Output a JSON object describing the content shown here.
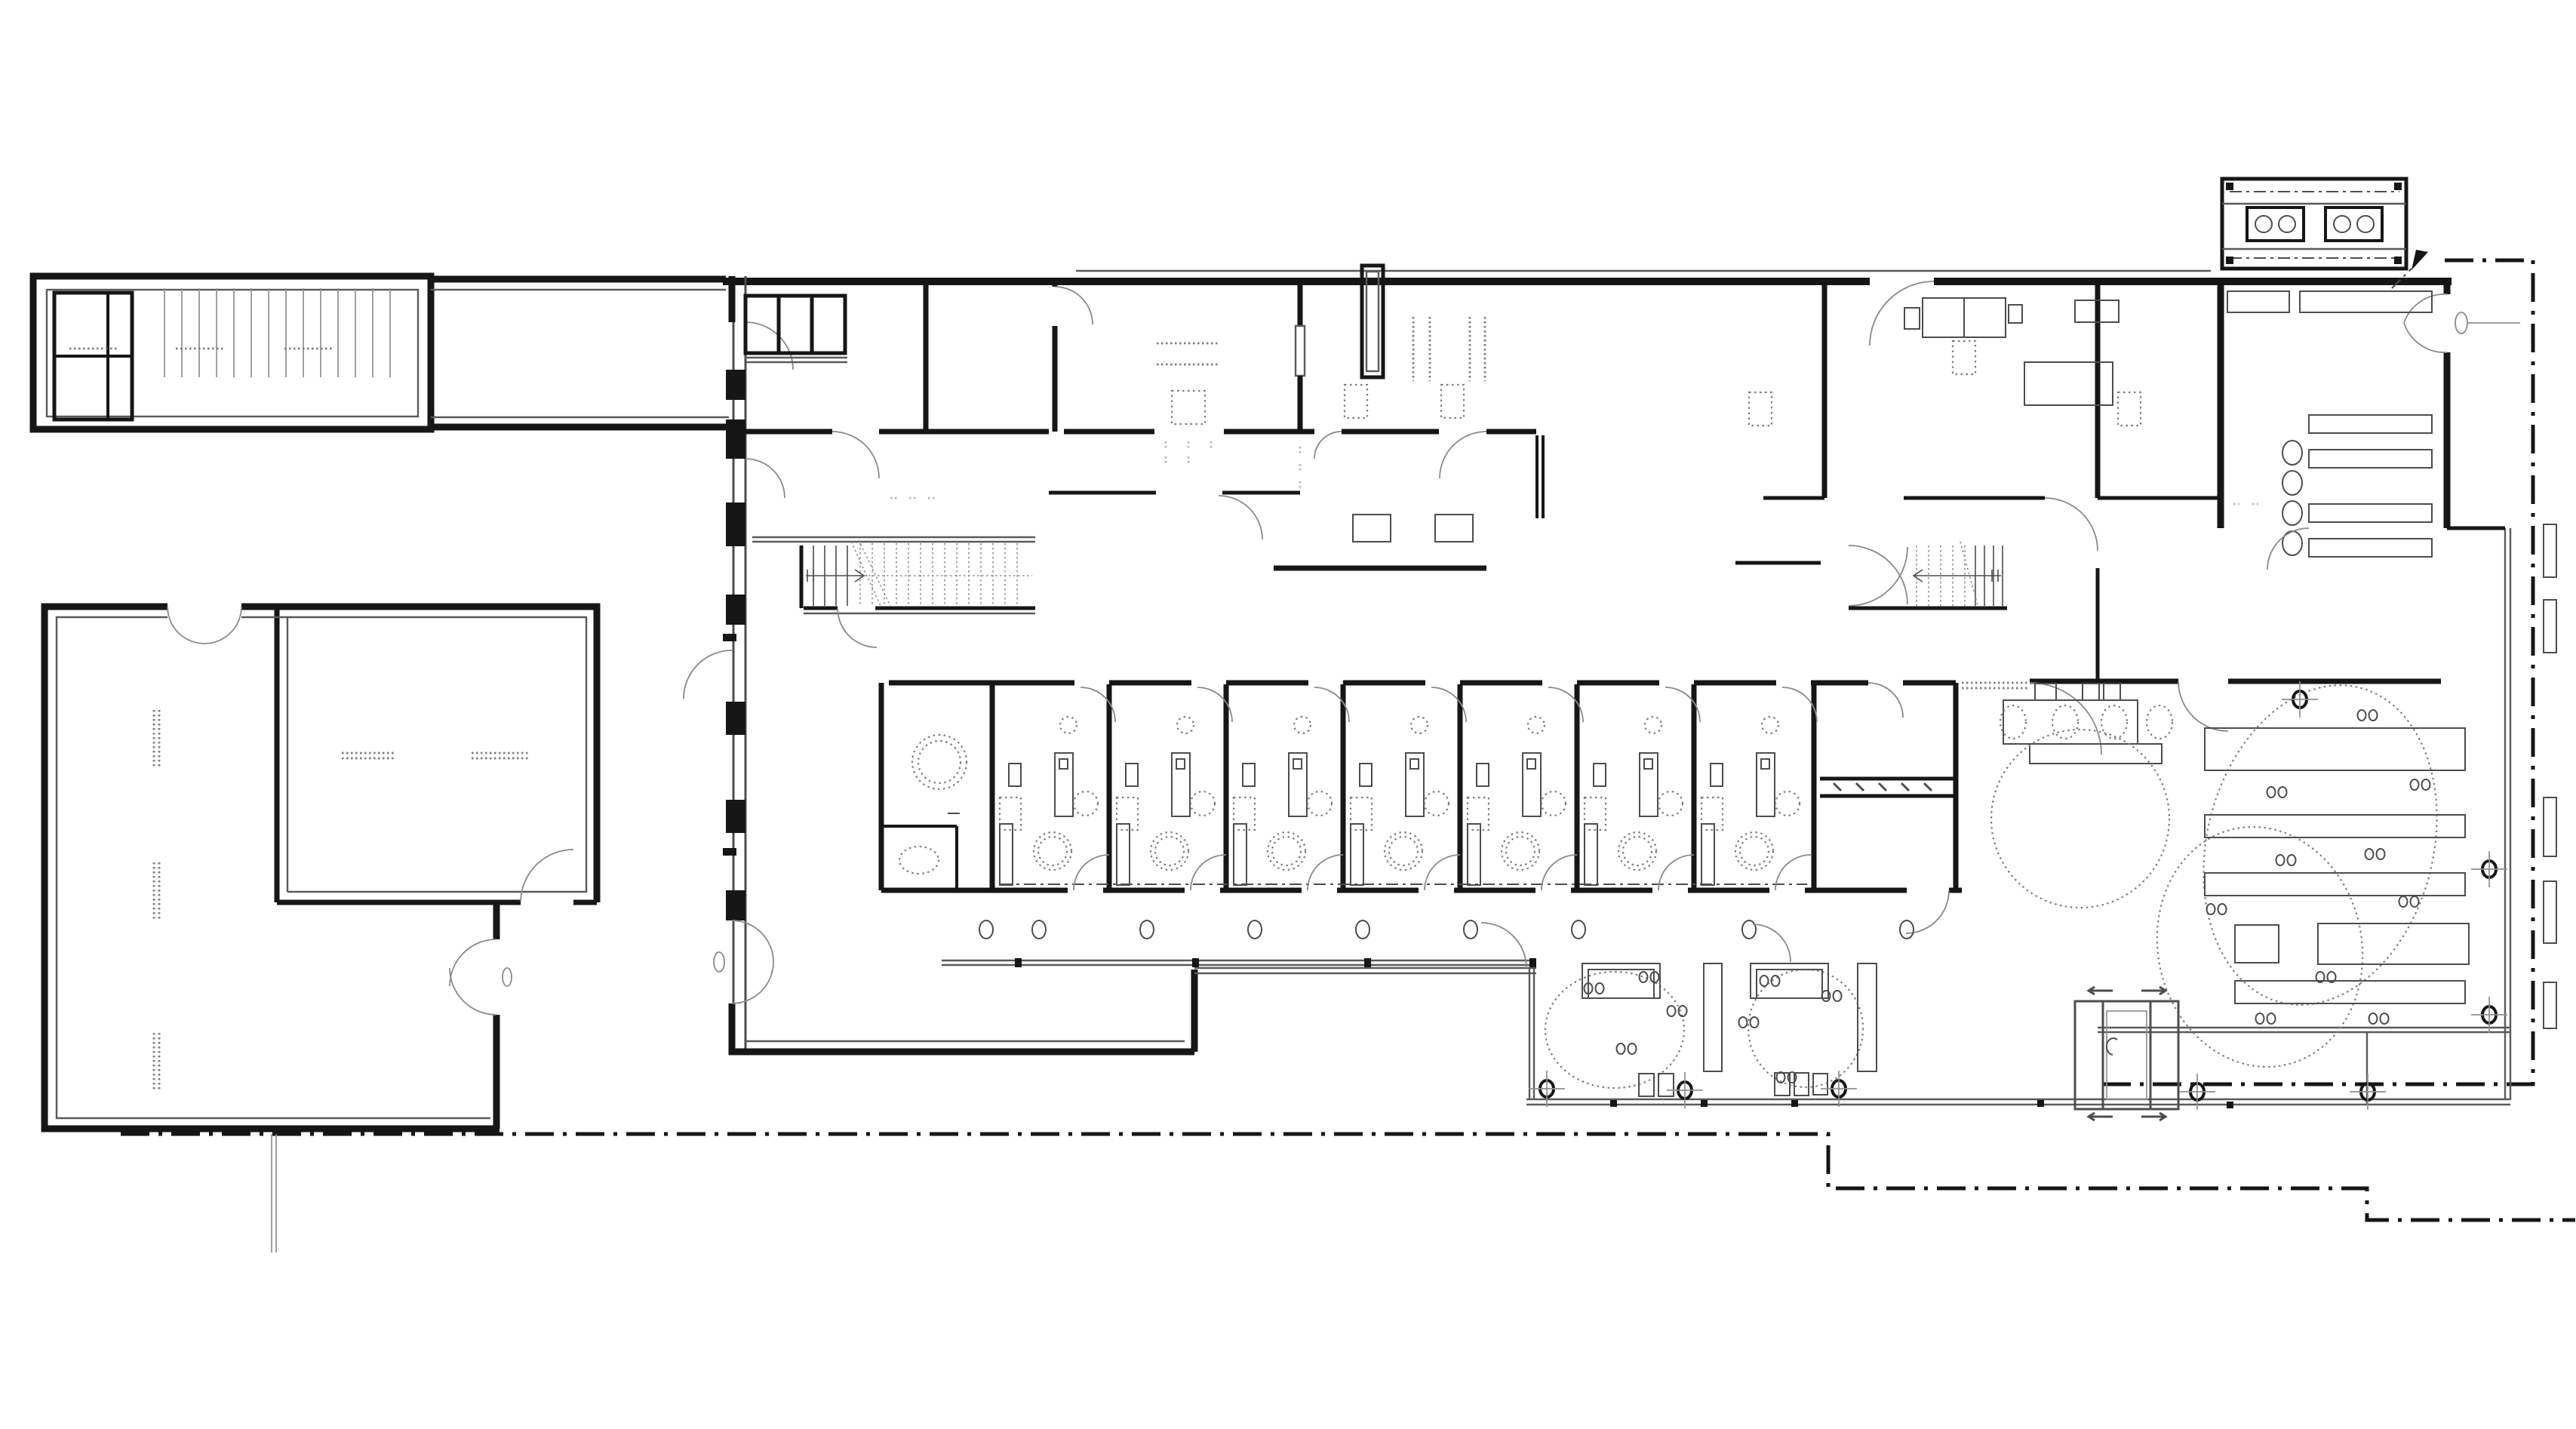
{
  "meta": {
    "title": "Ground-floor architectural plan — spa / wellness building",
    "drawing_type": "floor plan, black line work on white background",
    "visible_text": "none (drawing contains no legible labels or dimensions)"
  },
  "palette": {
    "paper": "#ffffff",
    "ink": "#161616",
    "mid": "#4d4d4d",
    "thin": "#5a5a5a",
    "light": "#909090",
    "arc": "#8a8a8a",
    "dotted": "#7d7d7d",
    "node_accent": "#00269a"
  },
  "features": {
    "zones": [
      {
        "name": "parking-garage-with-ramp",
        "position": "top-left"
      },
      {
        "name": "link-corridor",
        "position": "top-left to main building"
      },
      {
        "name": "top-room-band-offices-and-service",
        "position": "north strip of main building"
      },
      {
        "name": "two-staircases-dotted-hatch",
        "position": "central corridor"
      },
      {
        "name": "treatment-room-row",
        "count": 7,
        "position": "center"
      },
      {
        "name": "south-corridor-with-columns",
        "position": "below treatment rooms"
      },
      {
        "name": "entrance-foyer",
        "position": "west"
      },
      {
        "name": "annex-building-two-halls",
        "position": "lower-left"
      },
      {
        "name": "changing-room-with-benches",
        "position": "north-east"
      },
      {
        "name": "lounge-hall-reception-and-loungers",
        "position": "east"
      },
      {
        "name": "covered-terrace-two-round-pools-and-sauna",
        "position": "south-center"
      },
      {
        "name": "rooftop-equipment-unit",
        "position": "top-right, outside footprint"
      },
      {
        "name": "site-boundary-dash-dot-lines",
        "position": "right and bottom"
      }
    ],
    "symbols": [
      "door-swing-arc",
      "double-door-butterfly-arc",
      "stair-run-arrow",
      "column-marker-circle-cross",
      "column-circle",
      "massage-table",
      "dotted-stool-circle",
      "dotted-floor-mat",
      "lounger-pair-dots",
      "north-arrow",
      "sliding-door-arrows",
      "window-mullion-jamb"
    ]
  }
}
